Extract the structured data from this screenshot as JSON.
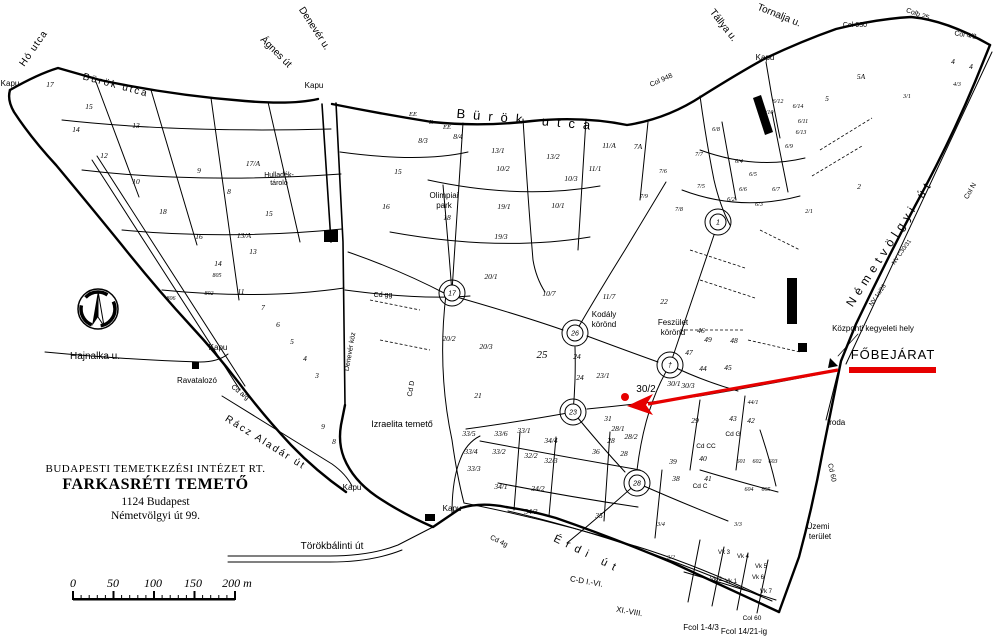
{
  "page": {
    "background": "#ffffff"
  },
  "colors": {
    "ink": "#000000",
    "red": "#e60000",
    "gray": "#666666"
  },
  "title_block": {
    "line1": "BUDAPESTI TEMETKEZÉSI INTÉZET RT.",
    "line2": "FARKASRÉTI TEMETŐ",
    "line3": "1124 Budapest",
    "line4": "Németvölgyi út 99."
  },
  "compass": {
    "label": "É"
  },
  "scale_bar": {
    "labels": [
      "0",
      "50",
      "100",
      "150",
      "200 m"
    ],
    "positions": [
      73,
      113,
      153,
      193,
      237
    ]
  },
  "entrance": {
    "label": "FŐBEJÁRAT",
    "note": "Központi kegyeleti hely"
  },
  "map": {
    "circles": [
      {
        "x": 452,
        "y": 293,
        "t": "17"
      },
      {
        "x": 575,
        "y": 333,
        "t": "26"
      },
      {
        "x": 573,
        "y": 412,
        "t": "23"
      },
      {
        "x": 637,
        "y": 483,
        "t": "28"
      },
      {
        "x": 718,
        "y": 222,
        "t": "1"
      },
      {
        "x": 670,
        "y": 365,
        "t": "†"
      }
    ],
    "labels": [
      {
        "t": "Hó utca",
        "x": 36,
        "y": 50,
        "r": -55,
        "s": 10,
        "ls": 1
      },
      {
        "t": "Bürök utca",
        "x": 115,
        "y": 88,
        "r": 15,
        "s": 10,
        "ls": 2
      },
      {
        "t": "Ágnes út",
        "x": 274,
        "y": 54,
        "r": 45,
        "s": 10
      },
      {
        "t": "Denevér u.",
        "x": 312,
        "y": 30,
        "r": 57,
        "s": 10
      },
      {
        "t": "Bürök utca",
        "x": 527,
        "y": 124,
        "r": 5,
        "s": 13,
        "ls": 8
      },
      {
        "t": "Tállya u.",
        "x": 721,
        "y": 27,
        "r": 52,
        "s": 10
      },
      {
        "t": "Tornalja u.",
        "x": 778,
        "y": 18,
        "r": 22,
        "s": 10
      },
      {
        "t": "Érdi út",
        "x": 586,
        "y": 557,
        "r": 26,
        "s": 11,
        "ls": 6
      },
      {
        "t": "Törökbálinti út",
        "x": 332,
        "y": 549,
        "s": 10
      },
      {
        "t": "Rácz Aladár út",
        "x": 264,
        "y": 445,
        "r": 32,
        "s": 10,
        "ls": 2
      },
      {
        "t": "Hajnalka u.",
        "x": 95,
        "y": 359,
        "s": 10
      },
      {
        "t": "Németvölgyi út",
        "x": 893,
        "y": 245,
        "r": -57,
        "s": 12,
        "ls": 5
      },
      {
        "t": "Denevér köz",
        "x": 352,
        "y": 352,
        "r": -80,
        "s": 7
      },
      {
        "t": "Kapu",
        "x": 10,
        "y": 86,
        "s": 8,
        "n": "gate-label"
      },
      {
        "t": "Kapu",
        "x": 314,
        "y": 88,
        "s": 8,
        "n": "gate-label"
      },
      {
        "t": "Kapu",
        "x": 765,
        "y": 60,
        "s": 8,
        "n": "gate-label"
      },
      {
        "t": "Kapu",
        "x": 218,
        "y": 350,
        "s": 8,
        "n": "gate-label"
      },
      {
        "t": "Kapu",
        "x": 352,
        "y": 490,
        "s": 8,
        "n": "gate-label"
      },
      {
        "t": "Kapu",
        "x": 452,
        "y": 511,
        "s": 8,
        "n": "gate-label"
      },
      {
        "t": "Col 930",
        "x": 855,
        "y": 27,
        "s": 7
      },
      {
        "t": "Colb 25",
        "x": 917,
        "y": 16,
        "r": 20,
        "s": 7
      },
      {
        "t": "Col 4/2",
        "x": 965,
        "y": 37,
        "r": 10,
        "s": 7
      },
      {
        "t": "Col 948",
        "x": 662,
        "y": 82,
        "r": -24,
        "s": 7
      },
      {
        "t": "Col N",
        "x": 972,
        "y": 192,
        "r": -60,
        "s": 7
      },
      {
        "t": "NV C30/31",
        "x": 903,
        "y": 253,
        "r": -55,
        "s": 6
      },
      {
        "t": "NV 1a/26",
        "x": 879,
        "y": 296,
        "r": -55,
        "s": 6
      },
      {
        "t": "Központi kegyeleti hely",
        "x": 873,
        "y": 331,
        "s": 8,
        "n": "central-memorial-label"
      },
      {
        "t": "FŐBEJÁRAT",
        "x": 893,
        "y": 359,
        "s": 13,
        "ls": 1,
        "n": "main-entrance-label"
      },
      {
        "t": "Iroda",
        "x": 827,
        "y": 425,
        "s": 8,
        "a": "start",
        "n": "office-label"
      },
      {
        "t": "Üzemi",
        "x": 818,
        "y": 529,
        "s": 8
      },
      {
        "t": "terület",
        "x": 820,
        "y": 539,
        "s": 8
      },
      {
        "t": "Ravatalozó",
        "x": 197,
        "y": 383,
        "s": 8,
        "n": "mortuary-label"
      },
      {
        "t": "Izraelita temető",
        "x": 402,
        "y": 427,
        "s": 9,
        "n": "jewish-cemetery-label"
      },
      {
        "t": "Olimpiai",
        "x": 444,
        "y": 198,
        "s": 8
      },
      {
        "t": "park",
        "x": 444,
        "y": 208,
        "s": 8
      },
      {
        "t": "Kodály",
        "x": 604,
        "y": 317,
        "s": 8
      },
      {
        "t": "körönd",
        "x": 604,
        "y": 327,
        "s": 8
      },
      {
        "t": "Feszület",
        "x": 673,
        "y": 325,
        "s": 8
      },
      {
        "t": "körönd",
        "x": 673,
        "y": 335,
        "s": 8
      },
      {
        "t": "Hulladék-",
        "x": 279,
        "y": 177,
        "s": 7
      },
      {
        "t": "tároló",
        "x": 279,
        "y": 185,
        "s": 7
      },
      {
        "t": "Cd gg",
        "x": 383,
        "y": 297,
        "s": 7
      },
      {
        "t": "Cd D",
        "x": 413,
        "y": 389,
        "r": -80,
        "s": 7
      },
      {
        "t": "Cd a/g",
        "x": 239,
        "y": 394,
        "r": 38,
        "s": 7
      },
      {
        "t": "Cd 4g",
        "x": 498,
        "y": 543,
        "r": 26,
        "s": 7
      },
      {
        "t": "Cd 60",
        "x": 830,
        "y": 473,
        "r": 78,
        "s": 7
      },
      {
        "t": "Cd G",
        "x": 733,
        "y": 436,
        "s": 6.5
      },
      {
        "t": "Cd CC",
        "x": 706,
        "y": 448,
        "s": 6.5
      },
      {
        "t": "Cd C",
        "x": 700,
        "y": 488,
        "s": 6.5
      },
      {
        "t": "C-D I.-VI.",
        "x": 586,
        "y": 584,
        "r": 10,
        "s": 8
      },
      {
        "t": "XI.-VIII.",
        "x": 629,
        "y": 614,
        "r": 10,
        "s": 8
      },
      {
        "t": "Fcol 1-4/3",
        "x": 701,
        "y": 630,
        "s": 8
      },
      {
        "t": "Fcol 14/21-ig",
        "x": 744,
        "y": 634,
        "s": 8
      },
      {
        "t": "Col 60",
        "x": 752,
        "y": 620,
        "s": 6.5
      },
      {
        "t": "17",
        "x": 50,
        "y": 87,
        "i": 1
      },
      {
        "t": "15",
        "x": 89,
        "y": 109,
        "i": 1
      },
      {
        "t": "13",
        "x": 136,
        "y": 128,
        "i": 1
      },
      {
        "t": "14",
        "x": 76,
        "y": 132,
        "i": 1
      },
      {
        "t": "12",
        "x": 104,
        "y": 158,
        "i": 1
      },
      {
        "t": "10",
        "x": 136,
        "y": 184,
        "i": 1
      },
      {
        "t": "9",
        "x": 199,
        "y": 173,
        "i": 1
      },
      {
        "t": "8",
        "x": 229,
        "y": 194,
        "i": 1
      },
      {
        "t": "17/A",
        "x": 253,
        "y": 166,
        "i": 1
      },
      {
        "t": "18",
        "x": 163,
        "y": 214,
        "i": 1
      },
      {
        "t": "16",
        "x": 199,
        "y": 239,
        "i": 1
      },
      {
        "t": "15",
        "x": 269,
        "y": 216,
        "i": 1
      },
      {
        "t": "13/A",
        "x": 244,
        "y": 238,
        "i": 1
      },
      {
        "t": "13",
        "x": 253,
        "y": 254,
        "i": 1
      },
      {
        "t": "14",
        "x": 218,
        "y": 266,
        "i": 1
      },
      {
        "t": "11",
        "x": 241,
        "y": 294,
        "i": 1
      },
      {
        "t": "7",
        "x": 263,
        "y": 310,
        "i": 1
      },
      {
        "t": "6",
        "x": 278,
        "y": 327,
        "i": 1
      },
      {
        "t": "5",
        "x": 292,
        "y": 344,
        "i": 1
      },
      {
        "t": "4",
        "x": 305,
        "y": 361,
        "i": 1
      },
      {
        "t": "3",
        "x": 317,
        "y": 378,
        "i": 1
      },
      {
        "t": "9",
        "x": 323,
        "y": 429,
        "i": 1
      },
      {
        "t": "8",
        "x": 334,
        "y": 444,
        "i": 1
      },
      {
        "t": "806",
        "x": 171,
        "y": 300,
        "s": 6,
        "i": 1
      },
      {
        "t": "805",
        "x": 217,
        "y": 277,
        "s": 6,
        "i": 1
      },
      {
        "t": "802",
        "x": 209,
        "y": 295,
        "s": 6,
        "i": 1
      },
      {
        "t": "EE",
        "x": 413,
        "y": 116,
        "s": 6.5,
        "i": 1
      },
      {
        "t": "E",
        "x": 431,
        "y": 124,
        "s": 6.5,
        "i": 1
      },
      {
        "t": "EE",
        "x": 447,
        "y": 129,
        "s": 6.5,
        "i": 1
      },
      {
        "t": "8/3",
        "x": 423,
        "y": 143,
        "i": 1
      },
      {
        "t": "8/4",
        "x": 458,
        "y": 139,
        "i": 1
      },
      {
        "t": "13/1",
        "x": 498,
        "y": 153,
        "i": 1
      },
      {
        "t": "13/2",
        "x": 553,
        "y": 159,
        "i": 1
      },
      {
        "t": "10/2",
        "x": 503,
        "y": 171,
        "i": 1
      },
      {
        "t": "11/A",
        "x": 609,
        "y": 148,
        "i": 1
      },
      {
        "t": "11/1",
        "x": 595,
        "y": 171,
        "i": 1
      },
      {
        "t": "10/3",
        "x": 571,
        "y": 181,
        "i": 1
      },
      {
        "t": "15",
        "x": 398,
        "y": 174,
        "i": 1
      },
      {
        "t": "16",
        "x": 386,
        "y": 209,
        "i": 1
      },
      {
        "t": "18",
        "x": 447,
        "y": 220,
        "i": 1
      },
      {
        "t": "19/1",
        "x": 504,
        "y": 209,
        "i": 1
      },
      {
        "t": "19/3",
        "x": 501,
        "y": 239,
        "i": 1
      },
      {
        "t": "10/1",
        "x": 558,
        "y": 208,
        "i": 1
      },
      {
        "t": "7A",
        "x": 638,
        "y": 149,
        "i": 1
      },
      {
        "t": "10/7",
        "x": 549,
        "y": 296,
        "i": 1
      },
      {
        "t": "11/7",
        "x": 609,
        "y": 299,
        "i": 1
      },
      {
        "t": "20/1",
        "x": 491,
        "y": 279,
        "i": 1
      },
      {
        "t": "20/2",
        "x": 449,
        "y": 341,
        "i": 1
      },
      {
        "t": "20/3",
        "x": 486,
        "y": 349,
        "i": 1
      },
      {
        "t": "22",
        "x": 664,
        "y": 304,
        "i": 1
      },
      {
        "t": "21",
        "x": 478,
        "y": 398,
        "i": 1
      },
      {
        "t": "25",
        "x": 542,
        "y": 358,
        "s": 11,
        "i": 1
      },
      {
        "t": "24",
        "x": 577,
        "y": 359,
        "i": 1
      },
      {
        "t": "24",
        "x": 580,
        "y": 380,
        "i": 1
      },
      {
        "t": "23/1",
        "x": 603,
        "y": 378,
        "i": 1
      },
      {
        "t": "46",
        "x": 701,
        "y": 333,
        "i": 1
      },
      {
        "t": "49",
        "x": 708,
        "y": 342,
        "i": 1
      },
      {
        "t": "48",
        "x": 734,
        "y": 343,
        "i": 1
      },
      {
        "t": "47",
        "x": 689,
        "y": 355,
        "i": 1
      },
      {
        "t": "44",
        "x": 703,
        "y": 371,
        "i": 1
      },
      {
        "t": "45",
        "x": 728,
        "y": 370,
        "i": 1
      },
      {
        "t": "30/1",
        "x": 674,
        "y": 386,
        "i": 1
      },
      {
        "t": "30/3",
        "x": 688,
        "y": 388,
        "i": 1
      },
      {
        "t": "30/2",
        "x": 646,
        "y": 392,
        "s": 10,
        "c": "#666666",
        "n": "parcel-30-2-label"
      },
      {
        "t": "29",
        "x": 695,
        "y": 423,
        "i": 1
      },
      {
        "t": "31",
        "x": 608,
        "y": 421,
        "i": 1
      },
      {
        "t": "28/1",
        "x": 618,
        "y": 431,
        "i": 1
      },
      {
        "t": "28/2",
        "x": 631,
        "y": 439,
        "i": 1
      },
      {
        "t": "28",
        "x": 611,
        "y": 443,
        "i": 1
      },
      {
        "t": "28",
        "x": 624,
        "y": 456,
        "i": 1
      },
      {
        "t": "36",
        "x": 596,
        "y": 454,
        "i": 1
      },
      {
        "t": "39",
        "x": 673,
        "y": 464,
        "i": 1
      },
      {
        "t": "40",
        "x": 703,
        "y": 461,
        "i": 1
      },
      {
        "t": "41",
        "x": 708,
        "y": 481,
        "i": 1
      },
      {
        "t": "38",
        "x": 676,
        "y": 481,
        "i": 1
      },
      {
        "t": "43",
        "x": 733,
        "y": 421,
        "i": 1
      },
      {
        "t": "42",
        "x": 751,
        "y": 423,
        "i": 1
      },
      {
        "t": "44/1",
        "x": 753,
        "y": 404,
        "s": 6,
        "i": 1
      },
      {
        "t": "33/5",
        "x": 469,
        "y": 436,
        "i": 1
      },
      {
        "t": "33/6",
        "x": 501,
        "y": 436,
        "i": 1
      },
      {
        "t": "33/4",
        "x": 471,
        "y": 454,
        "i": 1
      },
      {
        "t": "33/2",
        "x": 499,
        "y": 454,
        "i": 1
      },
      {
        "t": "33/3",
        "x": 474,
        "y": 471,
        "i": 1
      },
      {
        "t": "33/1",
        "x": 524,
        "y": 433,
        "i": 1
      },
      {
        "t": "34/4",
        "x": 551,
        "y": 443,
        "i": 1
      },
      {
        "t": "32/2",
        "x": 531,
        "y": 458,
        "i": 1
      },
      {
        "t": "32/3",
        "x": 551,
        "y": 463,
        "i": 1
      },
      {
        "t": "34/1",
        "x": 501,
        "y": 489,
        "i": 1
      },
      {
        "t": "34/2",
        "x": 538,
        "y": 491,
        "i": 1
      },
      {
        "t": "34/3",
        "x": 531,
        "y": 514,
        "i": 1
      },
      {
        "t": "35",
        "x": 599,
        "y": 518,
        "i": 1
      },
      {
        "t": "3/4",
        "x": 661,
        "y": 526,
        "s": 6,
        "i": 1
      },
      {
        "t": "3/2",
        "x": 671,
        "y": 559,
        "s": 6,
        "i": 1
      },
      {
        "t": "3/3",
        "x": 738,
        "y": 526,
        "s": 6,
        "i": 1
      },
      {
        "t": "Vk 3",
        "x": 724,
        "y": 554,
        "s": 6
      },
      {
        "t": "Vk 4",
        "x": 743,
        "y": 558,
        "s": 6
      },
      {
        "t": "Vk 2",
        "x": 716,
        "y": 581,
        "s": 6
      },
      {
        "t": "Vk 1",
        "x": 731,
        "y": 583,
        "s": 6
      },
      {
        "t": "Vk 5",
        "x": 761,
        "y": 568,
        "s": 6
      },
      {
        "t": "Vk 6",
        "x": 758,
        "y": 579,
        "s": 6
      },
      {
        "t": "Vk 7",
        "x": 766,
        "y": 593,
        "s": 6
      },
      {
        "t": "601",
        "x": 741,
        "y": 463,
        "s": 6,
        "i": 1
      },
      {
        "t": "602",
        "x": 757,
        "y": 463,
        "s": 6,
        "i": 1
      },
      {
        "t": "603",
        "x": 773,
        "y": 463,
        "s": 6,
        "i": 1
      },
      {
        "t": "604",
        "x": 749,
        "y": 491,
        "s": 6,
        "i": 1
      },
      {
        "t": "605",
        "x": 766,
        "y": 491,
        "s": 6,
        "i": 1
      },
      {
        "t": "5A",
        "x": 861,
        "y": 79,
        "i": 1
      },
      {
        "t": "5",
        "x": 827,
        "y": 101,
        "i": 1
      },
      {
        "t": "4",
        "x": 953,
        "y": 64,
        "i": 1
      },
      {
        "t": "4",
        "x": 971,
        "y": 69,
        "i": 1
      },
      {
        "t": "4/3",
        "x": 957,
        "y": 86,
        "s": 6,
        "i": 1
      },
      {
        "t": "3/1",
        "x": 907,
        "y": 98,
        "s": 6,
        "i": 1
      },
      {
        "t": "2",
        "x": 859,
        "y": 189,
        "i": 1
      },
      {
        "t": "2/1",
        "x": 809,
        "y": 213,
        "s": 6,
        "i": 1
      },
      {
        "t": "6/8",
        "x": 716,
        "y": 131,
        "s": 6,
        "i": 1
      },
      {
        "t": "6/12",
        "x": 778,
        "y": 103,
        "s": 6,
        "i": 1
      },
      {
        "t": "6/14",
        "x": 798,
        "y": 108,
        "s": 6,
        "i": 1
      },
      {
        "t": "6/10",
        "x": 768,
        "y": 114,
        "s": 6,
        "i": 1
      },
      {
        "t": "6/11",
        "x": 803,
        "y": 123,
        "s": 6,
        "i": 1
      },
      {
        "t": "6/13",
        "x": 801,
        "y": 134,
        "s": 6,
        "i": 1
      },
      {
        "t": "6/9",
        "x": 789,
        "y": 148,
        "s": 6,
        "i": 1
      },
      {
        "t": "6/4",
        "x": 739,
        "y": 163,
        "s": 6,
        "i": 1
      },
      {
        "t": "6/5",
        "x": 753,
        "y": 176,
        "s": 6,
        "i": 1
      },
      {
        "t": "6/6",
        "x": 743,
        "y": 191,
        "s": 6,
        "i": 1
      },
      {
        "t": "6/7",
        "x": 776,
        "y": 191,
        "s": 6,
        "i": 1
      },
      {
        "t": "6/2",
        "x": 731,
        "y": 201,
        "s": 6,
        "i": 1
      },
      {
        "t": "6/3",
        "x": 759,
        "y": 206,
        "s": 6,
        "i": 1
      },
      {
        "t": "7/7",
        "x": 699,
        "y": 156,
        "s": 6,
        "i": 1
      },
      {
        "t": "7/6",
        "x": 663,
        "y": 173,
        "s": 6,
        "i": 1
      },
      {
        "t": "7/5",
        "x": 701,
        "y": 188,
        "s": 6,
        "i": 1
      },
      {
        "t": "7/8",
        "x": 679,
        "y": 211,
        "s": 6,
        "i": 1
      },
      {
        "t": "7/9",
        "x": 644,
        "y": 198,
        "s": 6,
        "i": 1
      }
    ]
  }
}
